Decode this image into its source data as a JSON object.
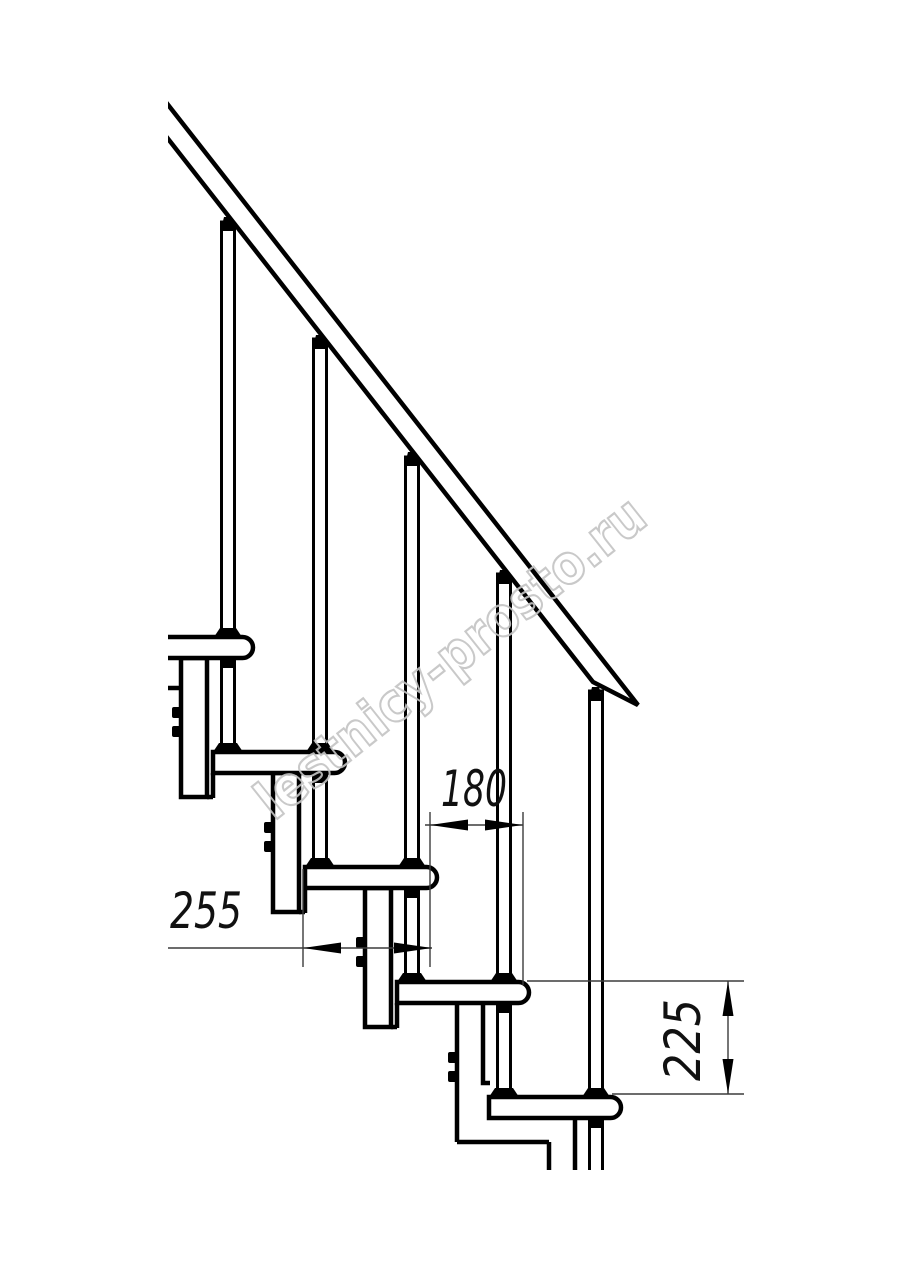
{
  "drawing": {
    "title": "staircase-side-elevation",
    "watermark": "lestnicy-prosto.ru",
    "dimensions": {
      "tread_depth": {
        "label": "255",
        "orientation": "horizontal"
      },
      "step_run": {
        "label": "180",
        "orientation": "horizontal"
      },
      "step_rise": {
        "label": "225",
        "orientation": "vertical"
      }
    },
    "counts": {
      "treads": 5,
      "balusters": 5
    },
    "colors": {
      "line": "#000000",
      "dimension_line": "#3c3c3c",
      "watermark": "#c4c4c4",
      "background": "#ffffff"
    }
  }
}
